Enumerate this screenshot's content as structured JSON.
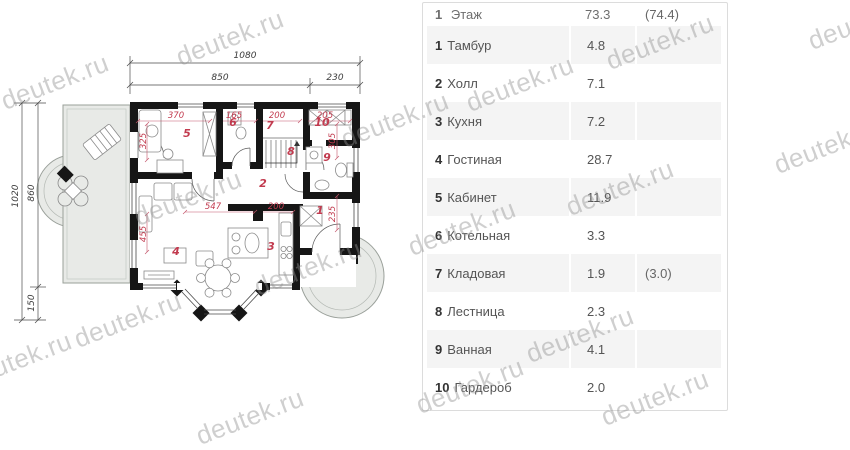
{
  "watermark": {
    "text": "deutek.ru",
    "positions": [
      [
        230,
        38
      ],
      [
        660,
        42
      ],
      [
        55,
        82
      ],
      [
        520,
        84
      ],
      [
        862,
        22
      ],
      [
        395,
        120
      ],
      [
        828,
        146
      ],
      [
        188,
        198
      ],
      [
        620,
        188
      ],
      [
        462,
        228
      ],
      [
        308,
        268
      ],
      [
        128,
        320
      ],
      [
        580,
        335
      ],
      [
        18,
        360
      ],
      [
        470,
        386
      ],
      [
        655,
        398
      ],
      [
        250,
        417
      ]
    ]
  },
  "table": {
    "header": {
      "num": "1",
      "name": "Этаж",
      "area": "73.3",
      "extra": "(74.4)"
    },
    "rows": [
      {
        "num": "1",
        "name": "Тамбур",
        "area": "4.8",
        "extra": ""
      },
      {
        "num": "2",
        "name": "Холл",
        "area": "7.1",
        "extra": ""
      },
      {
        "num": "3",
        "name": "Кухня",
        "area": "7.2",
        "extra": ""
      },
      {
        "num": "4",
        "name": "Гостиная",
        "area": "28.7",
        "extra": ""
      },
      {
        "num": "5",
        "name": "Кабинет",
        "area": "11.9",
        "extra": ""
      },
      {
        "num": "6",
        "name": "Котельная",
        "area": "3.3",
        "extra": ""
      },
      {
        "num": "7",
        "name": "Кладовая",
        "area": "1.9",
        "extra": "(3.0)"
      },
      {
        "num": "8",
        "name": "Лестница",
        "area": "2.3",
        "extra": ""
      },
      {
        "num": "9",
        "name": "Ванная",
        "area": "4.1",
        "extra": ""
      },
      {
        "num": "10",
        "name": "Гардероб",
        "area": "2.0",
        "extra": ""
      }
    ]
  },
  "plan": {
    "black_dims": [
      {
        "t": "1080",
        "x": 245,
        "y": 58,
        "rot": 0
      },
      {
        "t": "850",
        "x": 220,
        "y": 80,
        "rot": 0
      },
      {
        "t": "230",
        "x": 335,
        "y": 80,
        "rot": 0
      },
      {
        "t": "1020",
        "x": 18,
        "y": 196,
        "rot": -90
      },
      {
        "t": "860",
        "x": 34,
        "y": 193,
        "rot": -90
      },
      {
        "t": "150",
        "x": 34,
        "y": 303,
        "rot": -90
      }
    ],
    "red_dims": [
      {
        "t": "370",
        "x": 176,
        "y": 118,
        "rot": 0
      },
      {
        "t": "165",
        "x": 234,
        "y": 118,
        "rot": 0
      },
      {
        "t": "200",
        "x": 277,
        "y": 118,
        "rot": 0
      },
      {
        "t": "205",
        "x": 325,
        "y": 118,
        "rot": 0
      },
      {
        "t": "547",
        "x": 213,
        "y": 209,
        "rot": 0
      },
      {
        "t": "200",
        "x": 276,
        "y": 209,
        "rot": 0
      },
      {
        "t": "325",
        "x": 146,
        "y": 141,
        "rot": -90
      },
      {
        "t": "305",
        "x": 335,
        "y": 141,
        "rot": -90
      },
      {
        "t": "455",
        "x": 146,
        "y": 234,
        "rot": -90
      },
      {
        "t": "235",
        "x": 335,
        "y": 214,
        "rot": -90
      }
    ],
    "rooms": [
      {
        "n": "1",
        "x": 320,
        "y": 214
      },
      {
        "n": "2",
        "x": 263,
        "y": 187
      },
      {
        "n": "3",
        "x": 271,
        "y": 250
      },
      {
        "n": "4",
        "x": 176,
        "y": 255
      },
      {
        "n": "5",
        "x": 187,
        "y": 137
      },
      {
        "n": "6",
        "x": 233,
        "y": 126
      },
      {
        "n": "7",
        "x": 270,
        "y": 129
      },
      {
        "n": "8",
        "x": 291,
        "y": 155
      },
      {
        "n": "9",
        "x": 327,
        "y": 161
      },
      {
        "n": "10",
        "x": 322,
        "y": 126
      }
    ]
  }
}
